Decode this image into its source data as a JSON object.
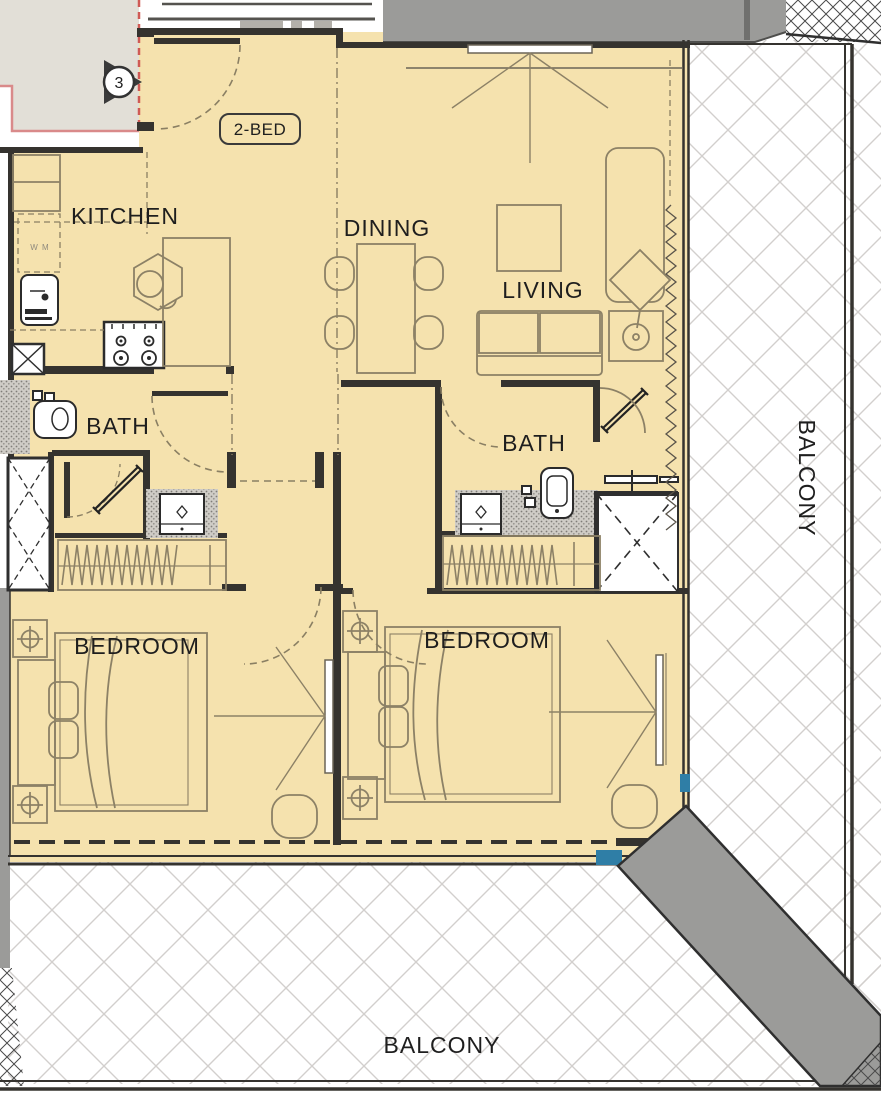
{
  "plan": {
    "type": "apartment-floor-plan",
    "unit_badge": "2-BED",
    "unit_marker": "3",
    "rooms": {
      "kitchen": "KITCHEN",
      "dining": "DINING",
      "living": "LIVING",
      "bath1": "BATH",
      "bath2": "BATH",
      "bedroom1": "BEDROOM",
      "bedroom2": "BEDROOM",
      "balcony_bottom": "BALCONY",
      "balcony_right": "BALCONY"
    },
    "appliance_labels": {
      "washing_machine": "W M"
    },
    "colors": {
      "floor": "#f5e2ae",
      "wall": "#35332f",
      "furniture_line": "#8c8166",
      "neighbor_fill": "#e2dfd7",
      "gray_band": "#9b9b99",
      "blue_accent": "#2f7ea6",
      "red_boundary": "#cf5a55",
      "pink_boundary": "#d98a8a",
      "hatch_line": "#d2cfcd"
    },
    "icons": [
      "entry-door-arc-icon",
      "stove-icon",
      "kitchen-sink-icon",
      "washing-machine-icon",
      "dining-table-icon",
      "dining-chair-icon",
      "sofa-icon",
      "chaise-icon",
      "armchair-icon",
      "floor-lamp-icon",
      "side-table-icon",
      "tv-icon",
      "rug-icon",
      "bed-icon",
      "pillow-icon",
      "nightstand-lamp-icon",
      "wardrobe-icon",
      "toilet-icon",
      "vanity-sink-icon",
      "shower-rod-icon",
      "shower-door-icon",
      "duct-x-icon",
      "window-coil-icon",
      "balcony-hatch-icon",
      "section-marker-icon"
    ]
  }
}
